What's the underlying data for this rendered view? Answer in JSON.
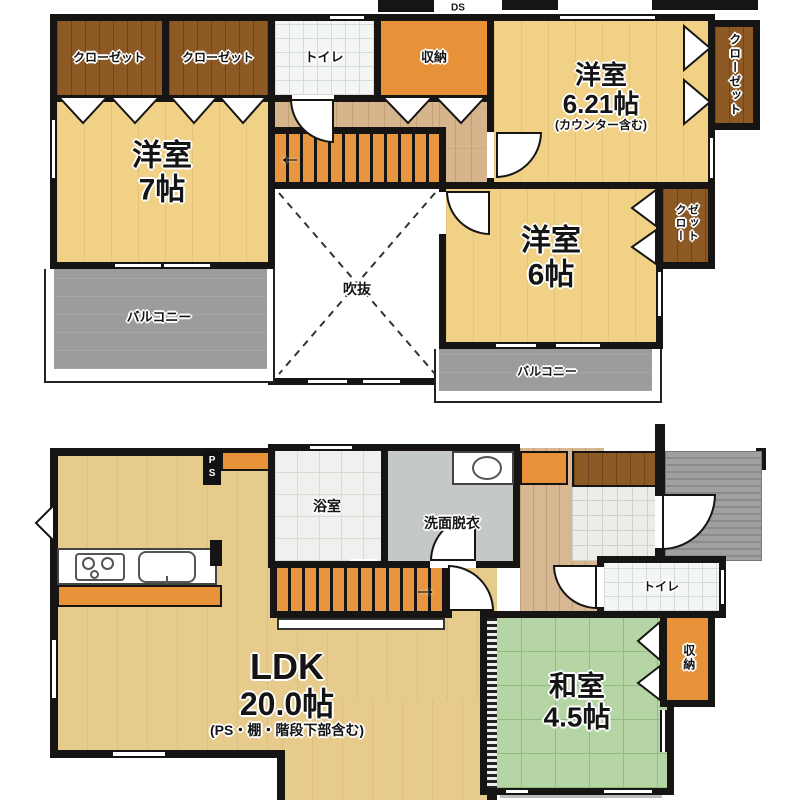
{
  "title": "2階建て住宅 間取り図",
  "floor2": {
    "ds": "DS",
    "closet_a": "クローゼット",
    "closet_b": "クローゼット",
    "toilet": "トイレ",
    "storage": "収納",
    "room7": {
      "name": "洋室",
      "size": "7帖"
    },
    "room621": {
      "name": "洋室",
      "size": "6.21帖",
      "note": "(カウンター含む)"
    },
    "closet_right_top": "クローゼット",
    "room6": {
      "name": "洋室",
      "size": "6帖"
    },
    "closet_right_mid_line1": "クロー",
    "closet_right_mid_line2": "ゼット",
    "void_label": "吹抜",
    "balcony_left": "バルコニー",
    "balcony_right": "バルコニー",
    "stair_arrow": "←"
  },
  "floor1": {
    "ps": "PS",
    "bath": "浴室",
    "wash": "洗面脱衣",
    "toilet": "トイレ",
    "ldk": {
      "name": "LDK",
      "size": "20.0帖",
      "note": "(PS・棚・階段下部含む)"
    },
    "washitsu": {
      "name": "和室",
      "size": "4.5帖"
    },
    "storage": "収納",
    "stair_arrow": "→"
  },
  "colors": {
    "wall": "#171513",
    "wood-room": "#F0D186",
    "wood-ldk": "#E7CB8C",
    "wood-hall": "#D6B58C",
    "brown": "#8D5A26",
    "orange": "#E79238",
    "stair": "#E8953F",
    "tatami": "#B5D6A4",
    "balcony": "#9C9C9C",
    "porch": "#9A9A9A",
    "tile": "#F0F1EF",
    "wash": "#C4C8C6"
  }
}
